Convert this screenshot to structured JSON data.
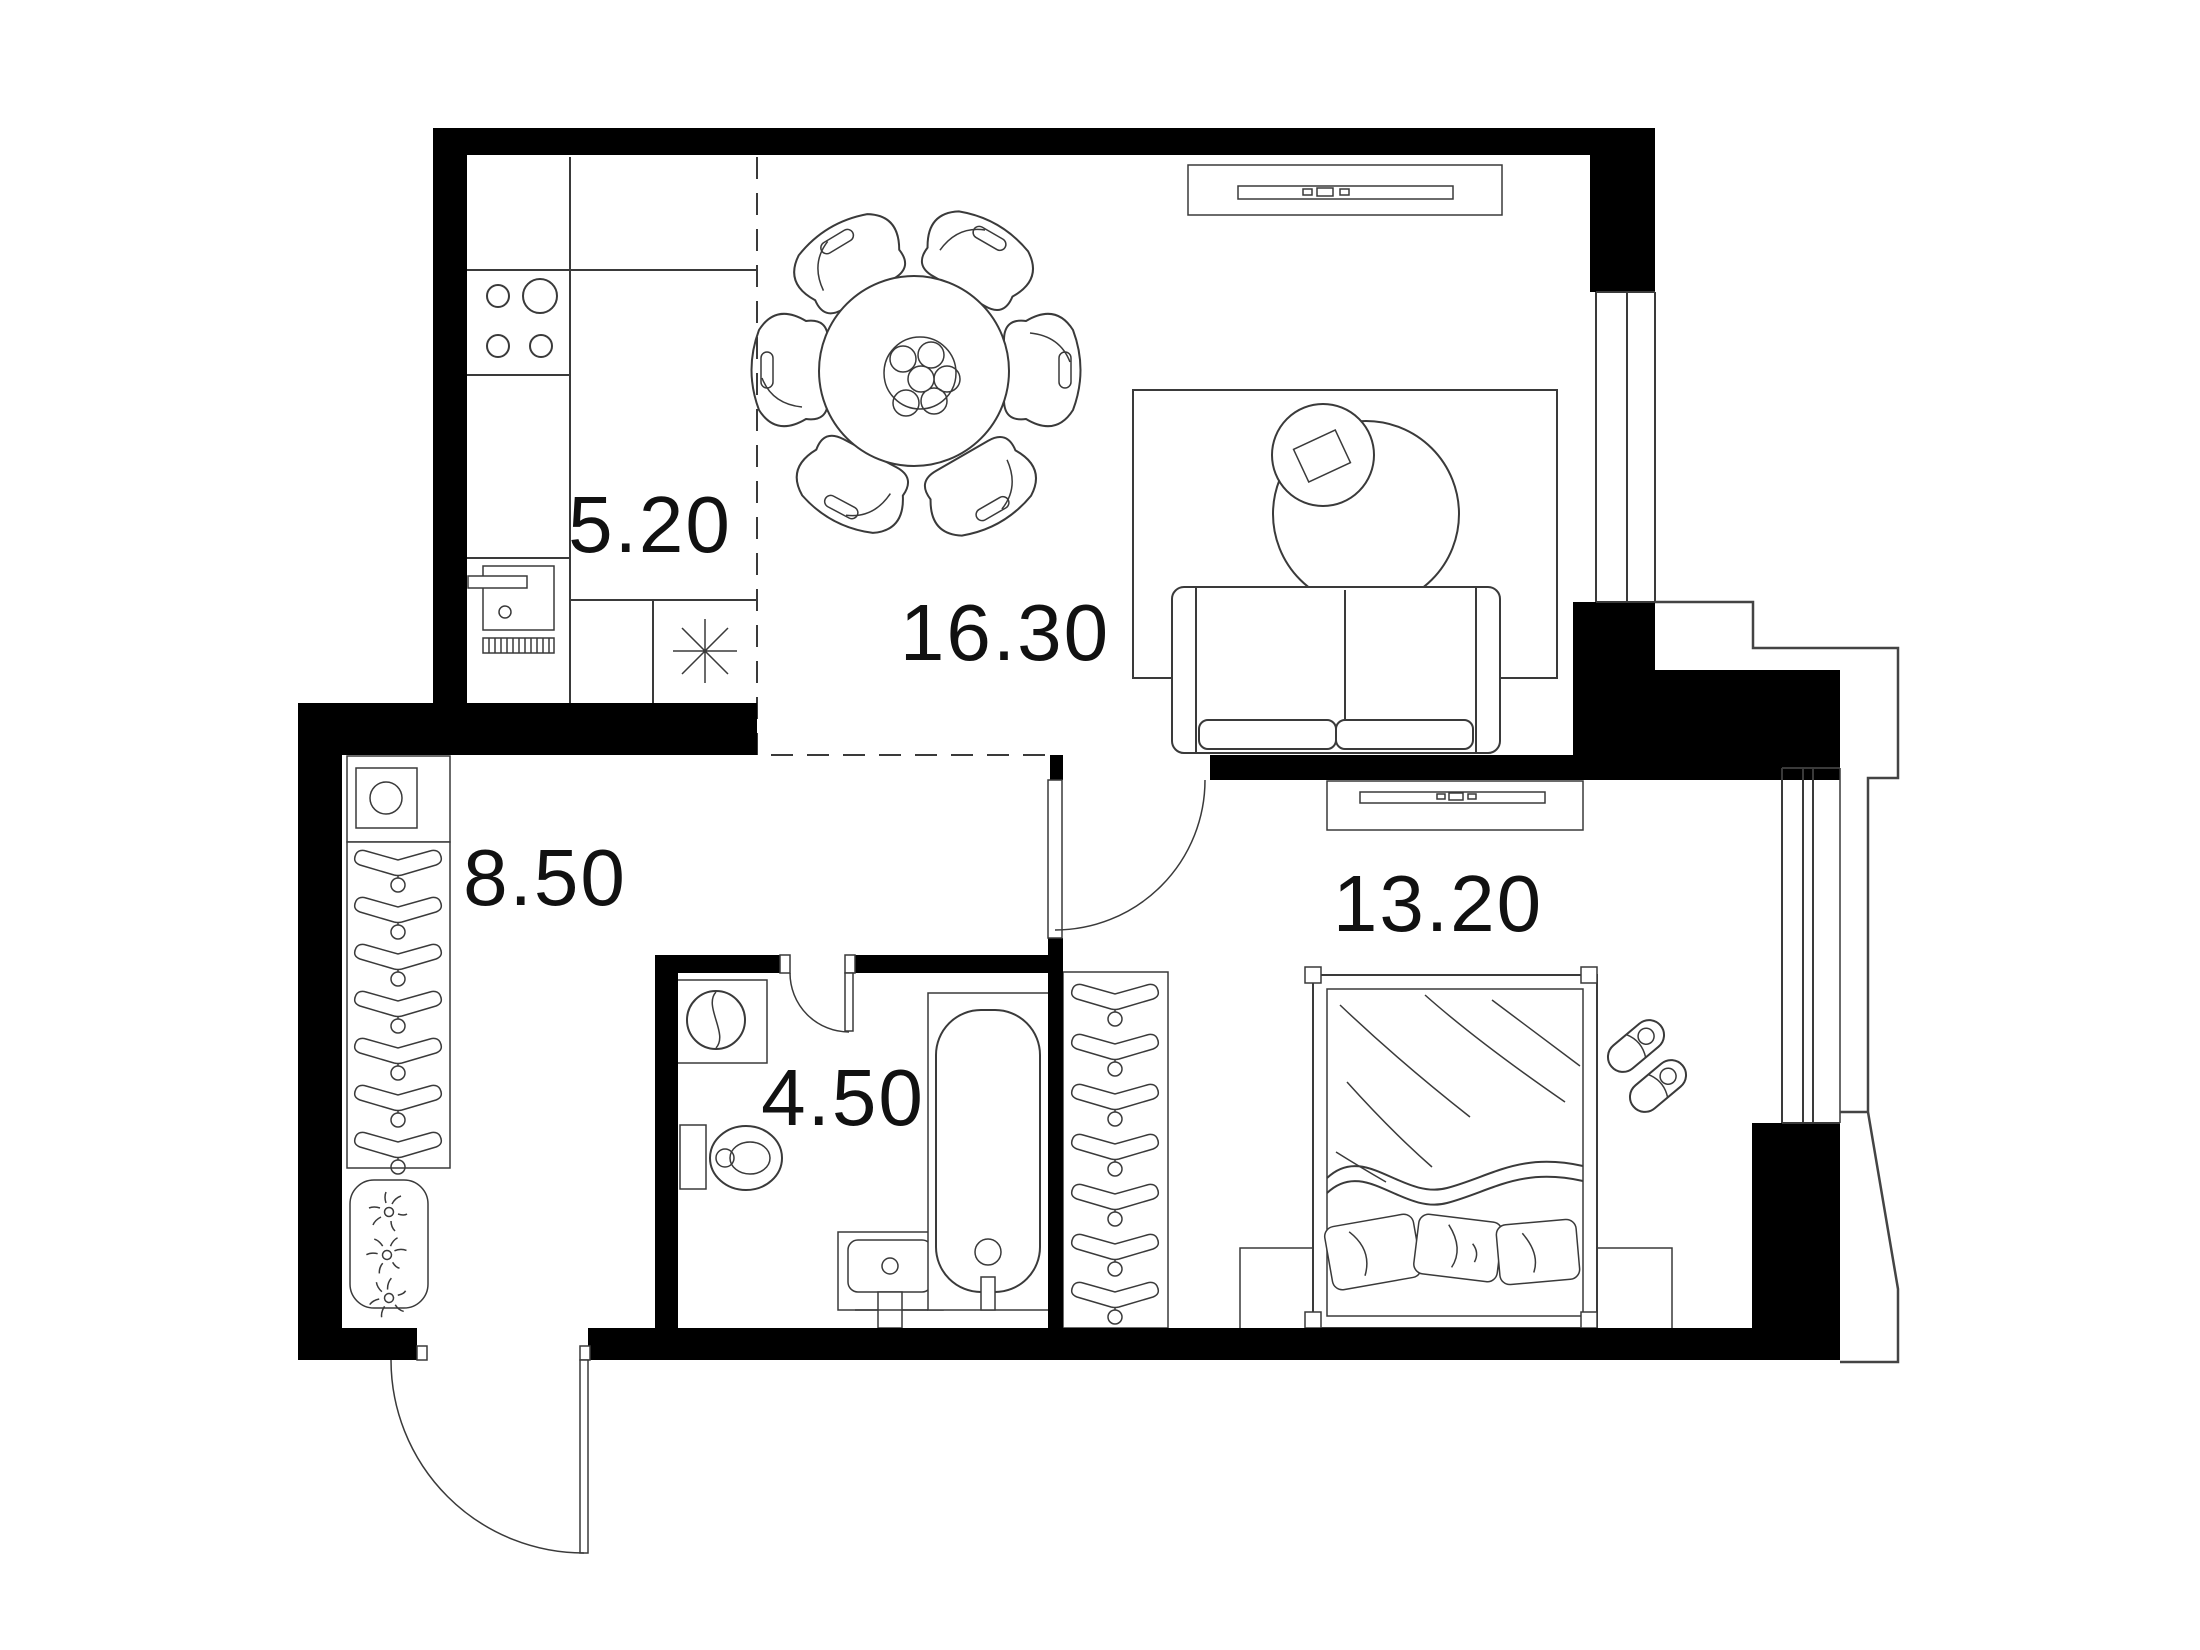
{
  "colors": {
    "background": "#ffffff",
    "walls": "#000000",
    "lines": "#3a3a3a",
    "text": "#111111"
  },
  "rooms": [
    {
      "id": "kitchen",
      "area": "5.20"
    },
    {
      "id": "living-dining",
      "area": "16.30"
    },
    {
      "id": "hallway",
      "area": "8.50"
    },
    {
      "id": "bathroom",
      "area": "4.50"
    },
    {
      "id": "bedroom",
      "area": "13.20"
    }
  ]
}
